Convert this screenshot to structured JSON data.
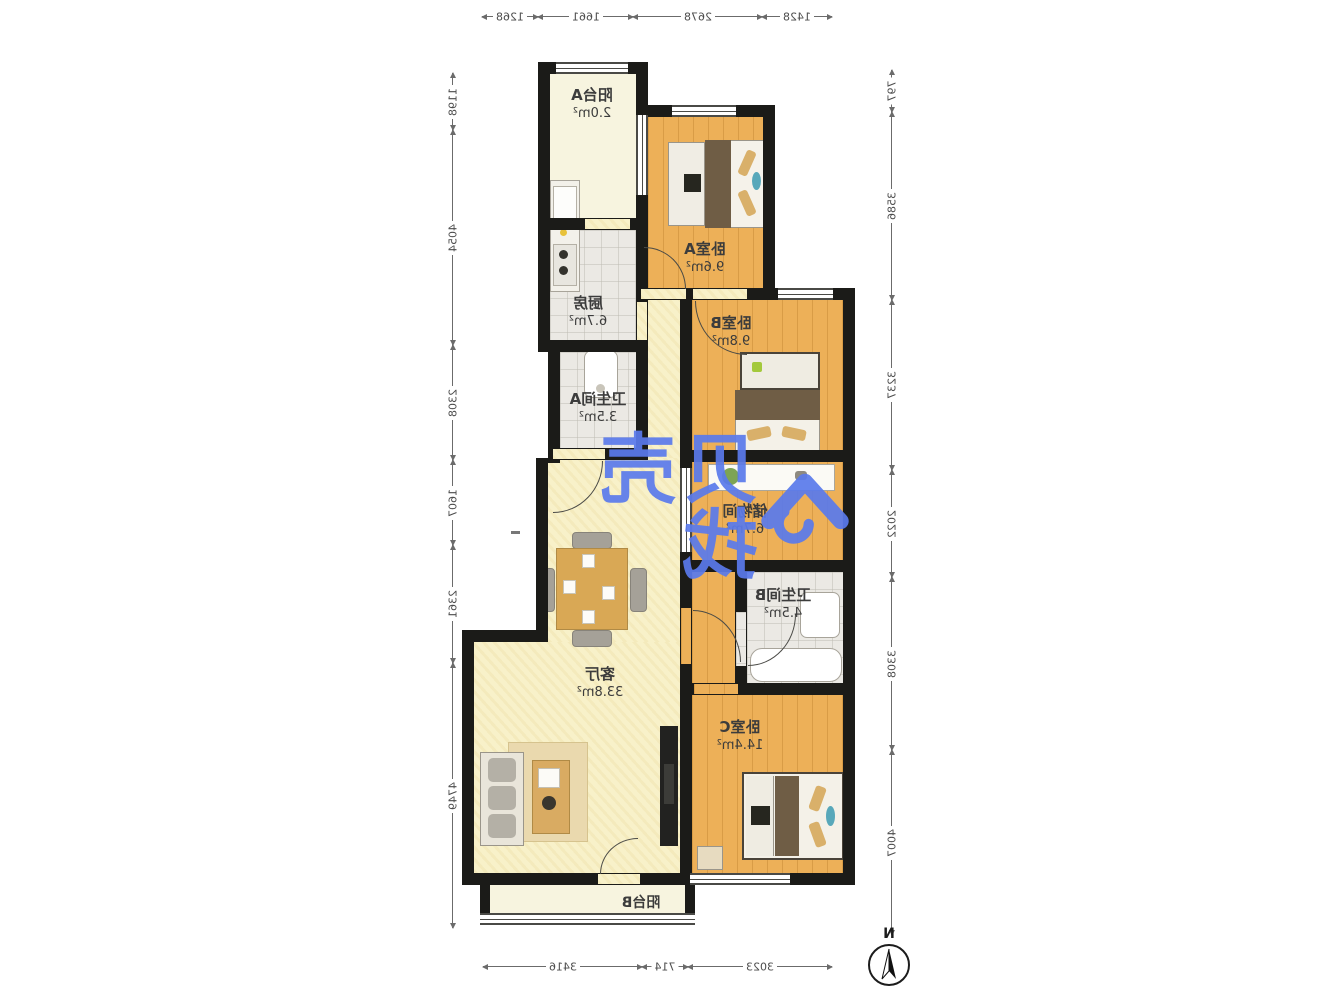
{
  "plan": {
    "type": "apartment-floorplan",
    "note": "floor plan rendered horizontally mirrored",
    "rooms": {
      "balconyA": {
        "name": "阳台A",
        "area": "2.0m²"
      },
      "kitchen": {
        "name": "厨房",
        "area": "6.7m²"
      },
      "bathA": {
        "name": "卫生间A",
        "area": "3.5m²"
      },
      "bedA": {
        "name": "卧室A",
        "area": "9.6m²"
      },
      "bedB": {
        "name": "卧室B",
        "area": "9.8m²"
      },
      "storage": {
        "name": "储物间",
        "area": "6.7m²"
      },
      "bathB": {
        "name": "卫生间B",
        "area": "4.5m²"
      },
      "living": {
        "name": "客厅",
        "area": "33.8m²"
      },
      "bedC": {
        "name": "卧室C",
        "area": "14.4m²"
      },
      "balconyB": {
        "name": "阳台B",
        "area": ""
      }
    },
    "dimensions": {
      "top": [
        "1268",
        "1661",
        "2678",
        "1428"
      ],
      "bottom": [
        "3416",
        "714",
        "3023"
      ],
      "left": [
        "1198",
        "4054",
        "2308",
        "1607",
        "2361",
        "4749"
      ],
      "right": [
        "797",
        "3586",
        "3237",
        "2022",
        "3308",
        "4007"
      ]
    },
    "watermark": {
      "text": "贝壳找",
      "logo": "beike-house-logo"
    },
    "compass": {
      "label": "N"
    },
    "colors": {
      "wall": "#1b1b18",
      "wood_floor": "#edb058",
      "living_floor": "#f8f1c9",
      "tile_floor": "#ebe9e4",
      "watermark_blue": "#5a7aec"
    }
  }
}
